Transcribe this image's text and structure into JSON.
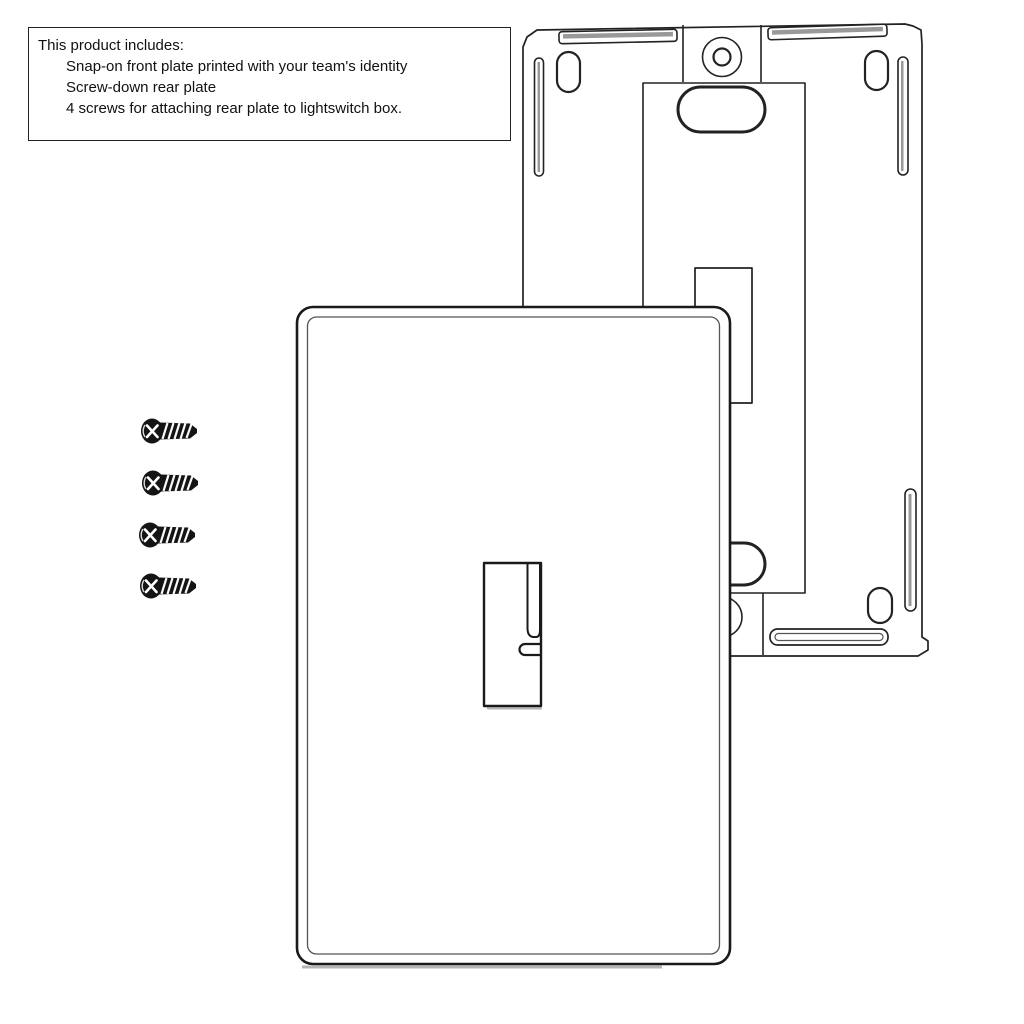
{
  "info_box": {
    "title": "This product includes:",
    "items": [
      "Snap-on front plate printed with your team's identity",
      "Screw-down rear plate",
      "4 screws for attaching rear plate to lightswitch box."
    ]
  },
  "illustration": {
    "screw_count": 4,
    "parts": {
      "front_plate": "snap-on front plate with toggle switch opening",
      "rear_plate": "screw-down rear mounting plate",
      "screws": "mounting screws"
    },
    "colors": {
      "line": "#222222",
      "line_strong": "#1a1a1a",
      "line_soft": "#555555",
      "slot_shade": "#999999",
      "shadow": "#b5b5b5",
      "screw_body": "#141414",
      "background": "#ffffff"
    }
  }
}
